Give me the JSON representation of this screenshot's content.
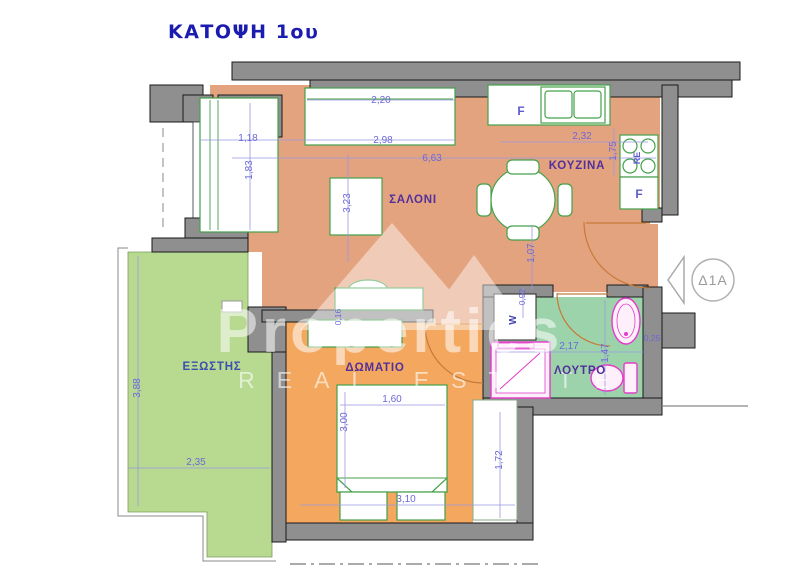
{
  "title": "ΚΑΤΟΨΗ 1ου",
  "unit_badge": "Δ1Α",
  "rooms": {
    "living_room": "ΣΑΛΟΝΙ",
    "kitchen": "ΚΟΥΖΙΝΑ",
    "bedroom": "ΔΩΜΑΤΙΟ",
    "bathroom": "ΛΟΥΤΡΟ",
    "balcony": "ΕΞΩΣΤΗΣ"
  },
  "appliances": {
    "fridge_label": "F",
    "kitchen_cabinet_label": "F",
    "stove_label": "RE",
    "washer_label": "W"
  },
  "dimensions": {
    "top_sofa_width": "2,20",
    "living_window_width": "2,98",
    "living_total_width": "6,63",
    "left_sofa_width": "1,18",
    "left_sofa_depth": "1,83",
    "living_depth": "3,23",
    "kitchen_width": "2,32",
    "kitchen_depth": "1,75",
    "hall_depth": "1,07",
    "bath_wall_offset": "0,92",
    "bath_width": "2,17",
    "bath_depth": "1,47",
    "bath_fixture_width": "0,25",
    "balcony_depth": "3,88",
    "balcony_width": "2,35",
    "bed_width": "1,60",
    "bed_length": "3,00",
    "bedroom_width": "3,10",
    "closet_depth": "1,72",
    "wall_thickness": "0,16"
  },
  "watermark": {
    "brand": "Properties",
    "tagline": "REAL ESTATE"
  },
  "colors": {
    "living_floor": "#e3a37f",
    "bedroom_floor": "#f3a75f",
    "bathroom_floor": "#9cd3ab",
    "balcony_floor": "#b7da90",
    "wall_gray": "#8f8f8f",
    "dimension_text": "#6b68d8",
    "room_label": "#52309b",
    "title_text": "#1b1bb0",
    "fixture_pink": "#e23cc8",
    "furniture_green": "#44a04a",
    "door_arc": "#c77a38"
  }
}
